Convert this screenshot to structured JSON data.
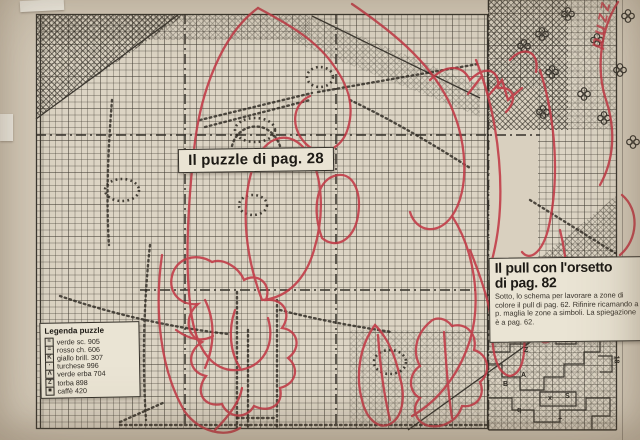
{
  "page": {
    "puzzle_label": "Il puzzle di pag. 28",
    "handwritten_annotation": "puzzle"
  },
  "article": {
    "title_line1": "Il pull con l'orsetto",
    "title_line2": "di pag. 82",
    "body": "Sotto, lo schema per lavorare a zone di colore il pull di pag. 62. Rifinire ricamando a p. maglia le zone a simboli. La spiegazione è a pag. 62."
  },
  "legend": {
    "title": "Legenda puzzle",
    "items": [
      {
        "symbol": "≡",
        "label": "verde sc. 905"
      },
      {
        "symbol": "=",
        "label": "rosso ch. 606"
      },
      {
        "symbol": "K",
        "label": "giallo brill. 307"
      },
      {
        "symbol": "·",
        "label": "turchese 996"
      },
      {
        "symbol": "Λ",
        "label": "verde erba 704"
      },
      {
        "symbol": "Z",
        "label": "torba 898"
      },
      {
        "symbol": "■",
        "label": "caffè 420"
      }
    ]
  },
  "zones": {
    "letters": [
      "Z",
      "A",
      "B",
      "S",
      "x",
      "+",
      "q"
    ],
    "rotated_labels": [
      "11",
      "18"
    ]
  },
  "colors": {
    "red": "#c23a46",
    "paper": "#d5cbba",
    "ink": "#2e2a24"
  }
}
